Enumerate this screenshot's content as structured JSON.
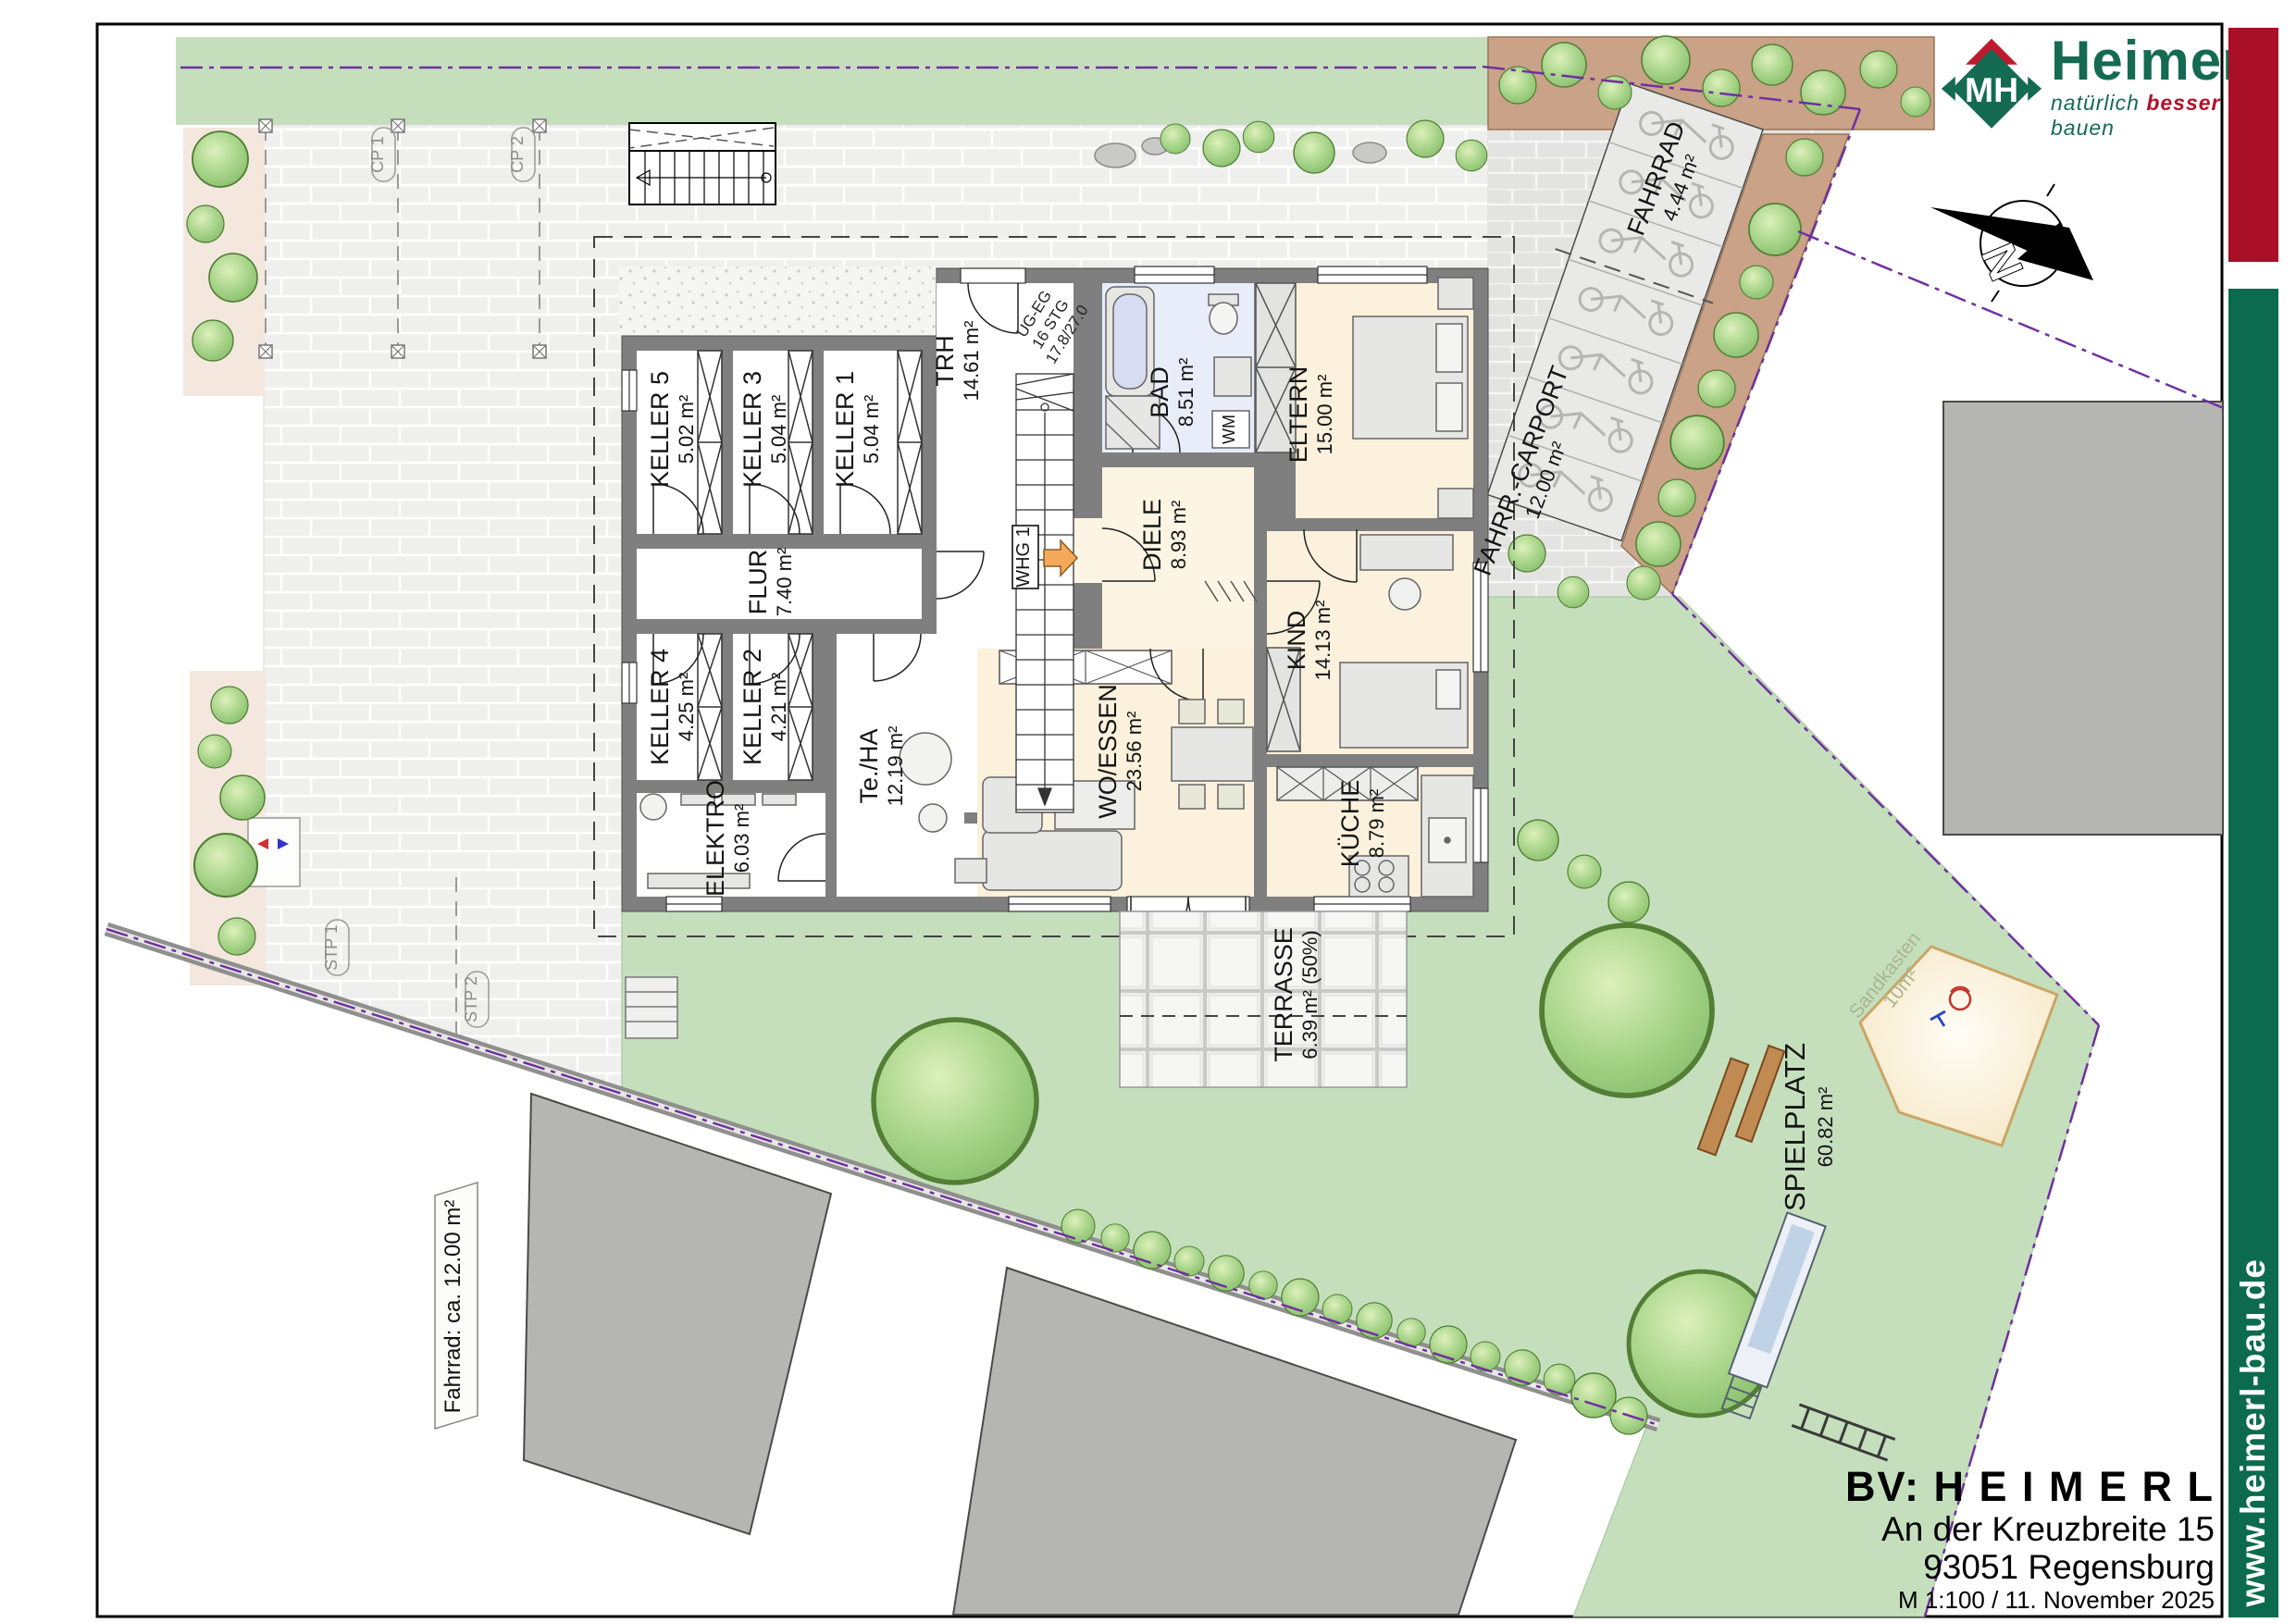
{
  "brand": {
    "monogram": "MH",
    "name": "Heimerl",
    "tagline_pre": "natürlich",
    "tagline_accent": "besser",
    "tagline_post": "bauen",
    "website": "www.heimerl-bau.de",
    "red": "#A90F26",
    "green": "#0C6B4E"
  },
  "titleblock": {
    "project": "BV: H E I M E R L",
    "address_line1": "An der Kreuzbreite 15",
    "address_line2": "93051 Regensburg",
    "scale_date": "M 1:100 / 11. November 2025"
  },
  "compass": {
    "label": "N"
  },
  "plan": {
    "whg_label": "WHG 1",
    "wm_label": "WM",
    "stair_note": {
      "line1": "UG-EG",
      "line2": "16 STG",
      "line3": "17.8/27.0"
    }
  },
  "rooms": [
    {
      "name": "KELLER 5",
      "area": "5.02 m²"
    },
    {
      "name": "KELLER 3",
      "area": "5.04 m²"
    },
    {
      "name": "KELLER 1",
      "area": "5.04 m²"
    },
    {
      "name": "KELLER 4",
      "area": "4.25 m²"
    },
    {
      "name": "KELLER 2",
      "area": "4.21 m²"
    },
    {
      "name": "FLUR",
      "area": "7.40 m²"
    },
    {
      "name": "ELEKTRO",
      "area": "6.03 m²"
    },
    {
      "name": "Te./HA",
      "area": "12.19 m²"
    },
    {
      "name": "TRH",
      "area": "14.61 m²"
    },
    {
      "name": "BAD",
      "area": "8.51 m²"
    },
    {
      "name": "ELTERN",
      "area": "15.00 m²"
    },
    {
      "name": "DIELE",
      "area": "8.93 m²"
    },
    {
      "name": "KIND",
      "area": "14.13 m²"
    },
    {
      "name": "WO/ESSEN",
      "area": "23.56 m²"
    },
    {
      "name": "KÜCHE",
      "area": "8.79 m²"
    },
    {
      "name": "TERRASSE",
      "area": "6.39 m² (50%)"
    }
  ],
  "outdoor": {
    "spielplatz": {
      "name": "SPIELPLATZ",
      "area": "60.82 m²"
    },
    "sandbox": {
      "name": "Sandkasten",
      "area": "10m²"
    },
    "bike_parking": {
      "name": "FAHRRAD",
      "area": "4.44 m²"
    },
    "bike_carport": {
      "name": "FAHRR.-CARPORT",
      "area": "12.00 m²"
    },
    "bike_note": "Fahrrad: ca. 12.00 m²"
  },
  "parking": {
    "carport_spots": [
      "CP 1",
      "CP 2"
    ],
    "outdoor_spots": [
      "STP 1",
      "STP 2"
    ]
  },
  "colors": {
    "lawn": "#C5DFBD",
    "paving": "#EFEFED",
    "wall": "#7F7F7F",
    "boundary": "#7030A0",
    "planting": "#C9A287",
    "room_beige": "#FBF1DC",
    "bath_blue": "#E9EDF9"
  }
}
